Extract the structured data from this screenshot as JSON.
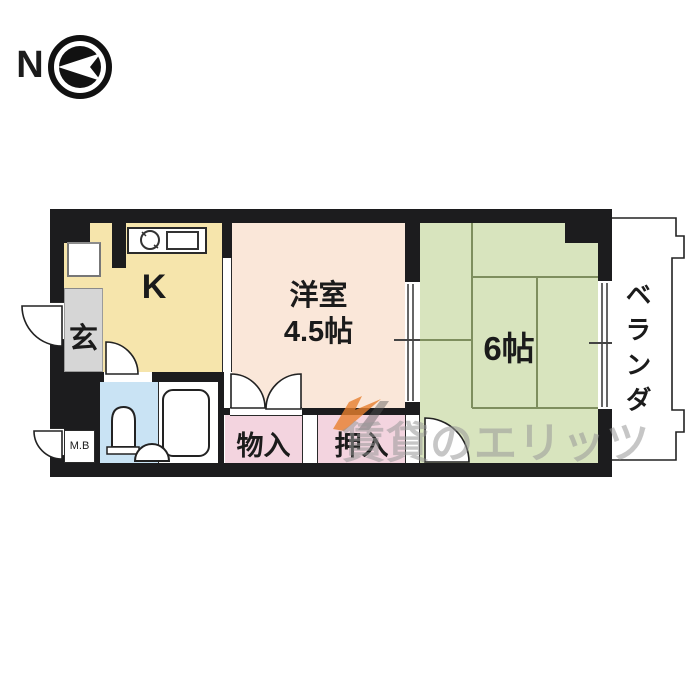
{
  "compass": {
    "label": "N"
  },
  "rooms": {
    "kitchen": {
      "label": "K"
    },
    "entrance": {
      "label": "玄"
    },
    "western_room": {
      "name": "洋室",
      "size": "4.5帖"
    },
    "tatami_room": {
      "size": "6帖"
    },
    "veranda": {
      "label": "ベランダ"
    },
    "storage": {
      "label": "物入"
    },
    "closet": {
      "label": "押入"
    },
    "meter_box": {
      "label": "M.B"
    }
  },
  "icons": [
    "north-compass-icon",
    "sink-icon",
    "stove-icon",
    "refrigerator-space",
    "toilet-icon",
    "washbasin-icon",
    "bathtub-icon",
    "door-swing-arc",
    "double-folding-door",
    "sliding-door",
    "window",
    "watermark-logo"
  ],
  "watermark": {
    "text": "賃貸のエリッツ"
  },
  "colors": {
    "wall": "#1c1c1e",
    "kitchen": "#f6e5ac",
    "entrance": "#d6d6d6",
    "western_room": "#fae7d9",
    "tatami_room": "#d8e4be",
    "tatami_line": "#7e8e5e",
    "bathroom": "#c9e3f4",
    "closet": "#f3d4df",
    "watermark_gray": "#999999",
    "watermark_orange": "#e8802f"
  }
}
